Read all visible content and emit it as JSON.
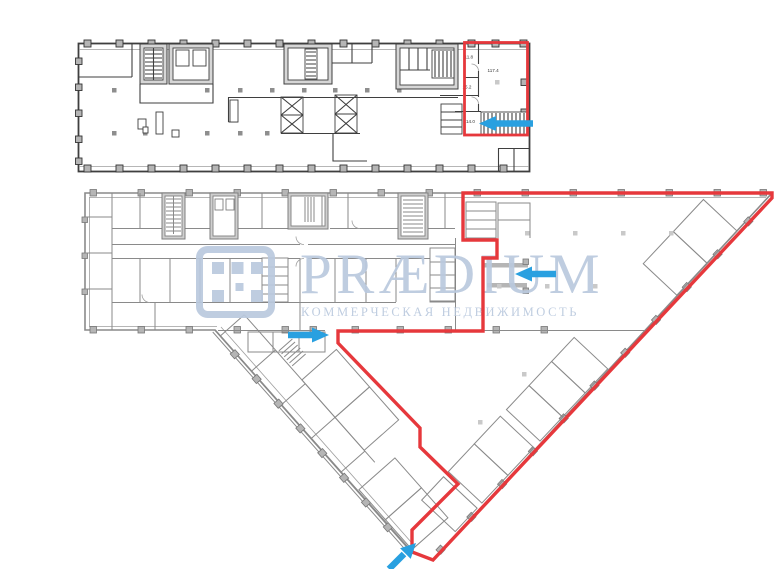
{
  "watermark": {
    "brand": "PRÆDIUM",
    "subtitle": "КОММЕРЧЕСКАЯ НЕДВИЖИМОСТЬ"
  },
  "colors": {
    "background": "#ffffff",
    "highlight": "#e6383c",
    "arrow": "#29a0e0",
    "watermark": "#bac9de",
    "wall_dark": "#3f3f3f",
    "wall_gray": "#8a8a8a",
    "core_fill": "#d6d6d6",
    "column_fill": "#b5b5b5"
  },
  "upper_plan": {
    "name": "Upper floor plan",
    "rooms": [
      {
        "area": "11.8"
      },
      {
        "area": "117.4"
      },
      {
        "area": "15.2"
      },
      {
        "area": "14.0"
      }
    ]
  },
  "lower_plan": {
    "name": "Lower floor plan"
  },
  "arrows": [
    {
      "id": "upper-plan-entry",
      "direction": "left"
    },
    {
      "id": "lower-plan-entry-right",
      "direction": "left"
    },
    {
      "id": "lower-plan-entry-left",
      "direction": "right"
    },
    {
      "id": "lower-plan-entry-bottom",
      "direction": "up-right"
    }
  ]
}
